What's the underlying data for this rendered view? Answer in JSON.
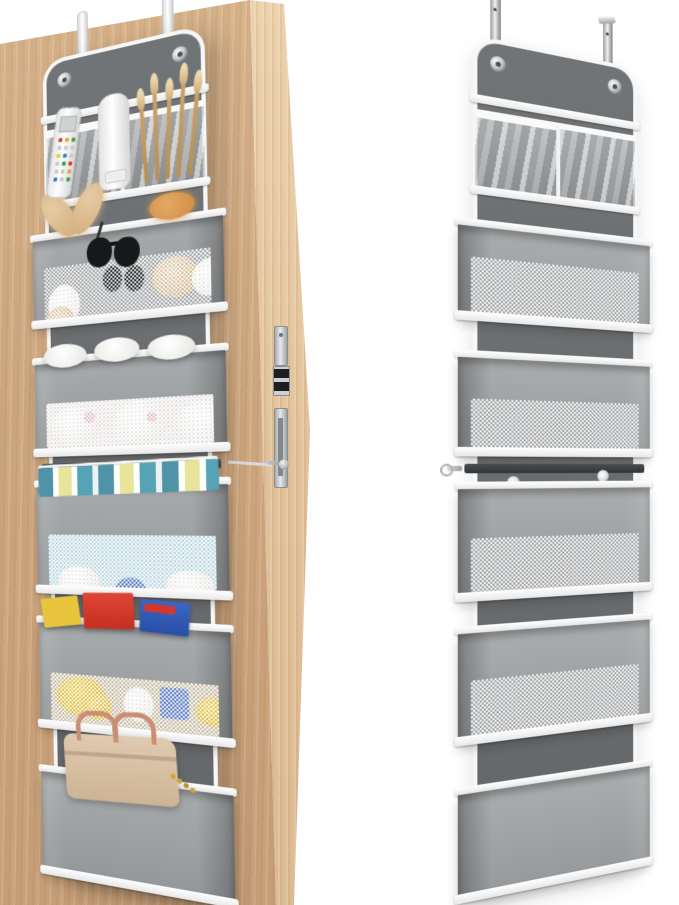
{
  "scene": {
    "type": "product-photo",
    "description": "Over-the-door hanging organizer shown twice: mounted on a wooden door filled with items (left) and standalone empty (right)",
    "background_color": "#ffffff"
  },
  "palette": {
    "door_wood": "#cfa981",
    "door_edge_wood": "#e2c29a",
    "organizer_back_panel": "#6b6e70",
    "pocket_fabric": "#9fa2a4",
    "trim_white": "#f7f7f7",
    "metal_silver": "#c6c9cb",
    "mesh_white": "#ffffff"
  },
  "left_view": {
    "name": "organizer-on-door-with-items",
    "door": {
      "material": "light-wood",
      "hardware": [
        "latch-plate",
        "latch-bolt",
        "strike-plate",
        "mounting-screw"
      ]
    },
    "organizer": {
      "hanging_hooks": {
        "count": 2,
        "style": "white-over-door-straps"
      },
      "grommets": 2,
      "rows": [
        {
          "type": "clear-pvc-pockets",
          "items": [
            "remote-control",
            "lotion-tube",
            "makeup-brushes"
          ]
        },
        {
          "type": "mesh-bin",
          "items": [
            "plush-headband",
            "hair-scrunchie",
            "sunglasses",
            "cosmetics"
          ]
        },
        {
          "type": "mesh-bin",
          "items": [
            "folded-baby-clothes"
          ]
        },
        {
          "type": "mesh-bin",
          "items": [
            "diapers"
          ]
        },
        {
          "type": "mesh-bin",
          "items": [
            "yellow-folder",
            "red-book",
            "blue-book",
            "toys"
          ]
        },
        {
          "type": "plain-bin",
          "items": [
            "handbag"
          ]
        }
      ],
      "middle_anchor": "strap-to-door-edge-screw"
    }
  },
  "right_view": {
    "name": "organizer-standalone-empty",
    "organizer": {
      "hanging_hooks": {
        "count": 2,
        "style": "metal-over-door-hooks"
      },
      "grommets": 2,
      "mid_grommets": 2,
      "rows": [
        {
          "type": "clear-pvc-pockets",
          "items": []
        },
        {
          "type": "mesh-bin",
          "items": []
        },
        {
          "type": "mesh-bin",
          "items": []
        },
        {
          "type": "mesh-bin",
          "items": []
        },
        {
          "type": "mesh-bin",
          "items": []
        },
        {
          "type": "plain-bin",
          "items": []
        }
      ],
      "middle_anchor": "strap-with-metal-hook"
    }
  }
}
